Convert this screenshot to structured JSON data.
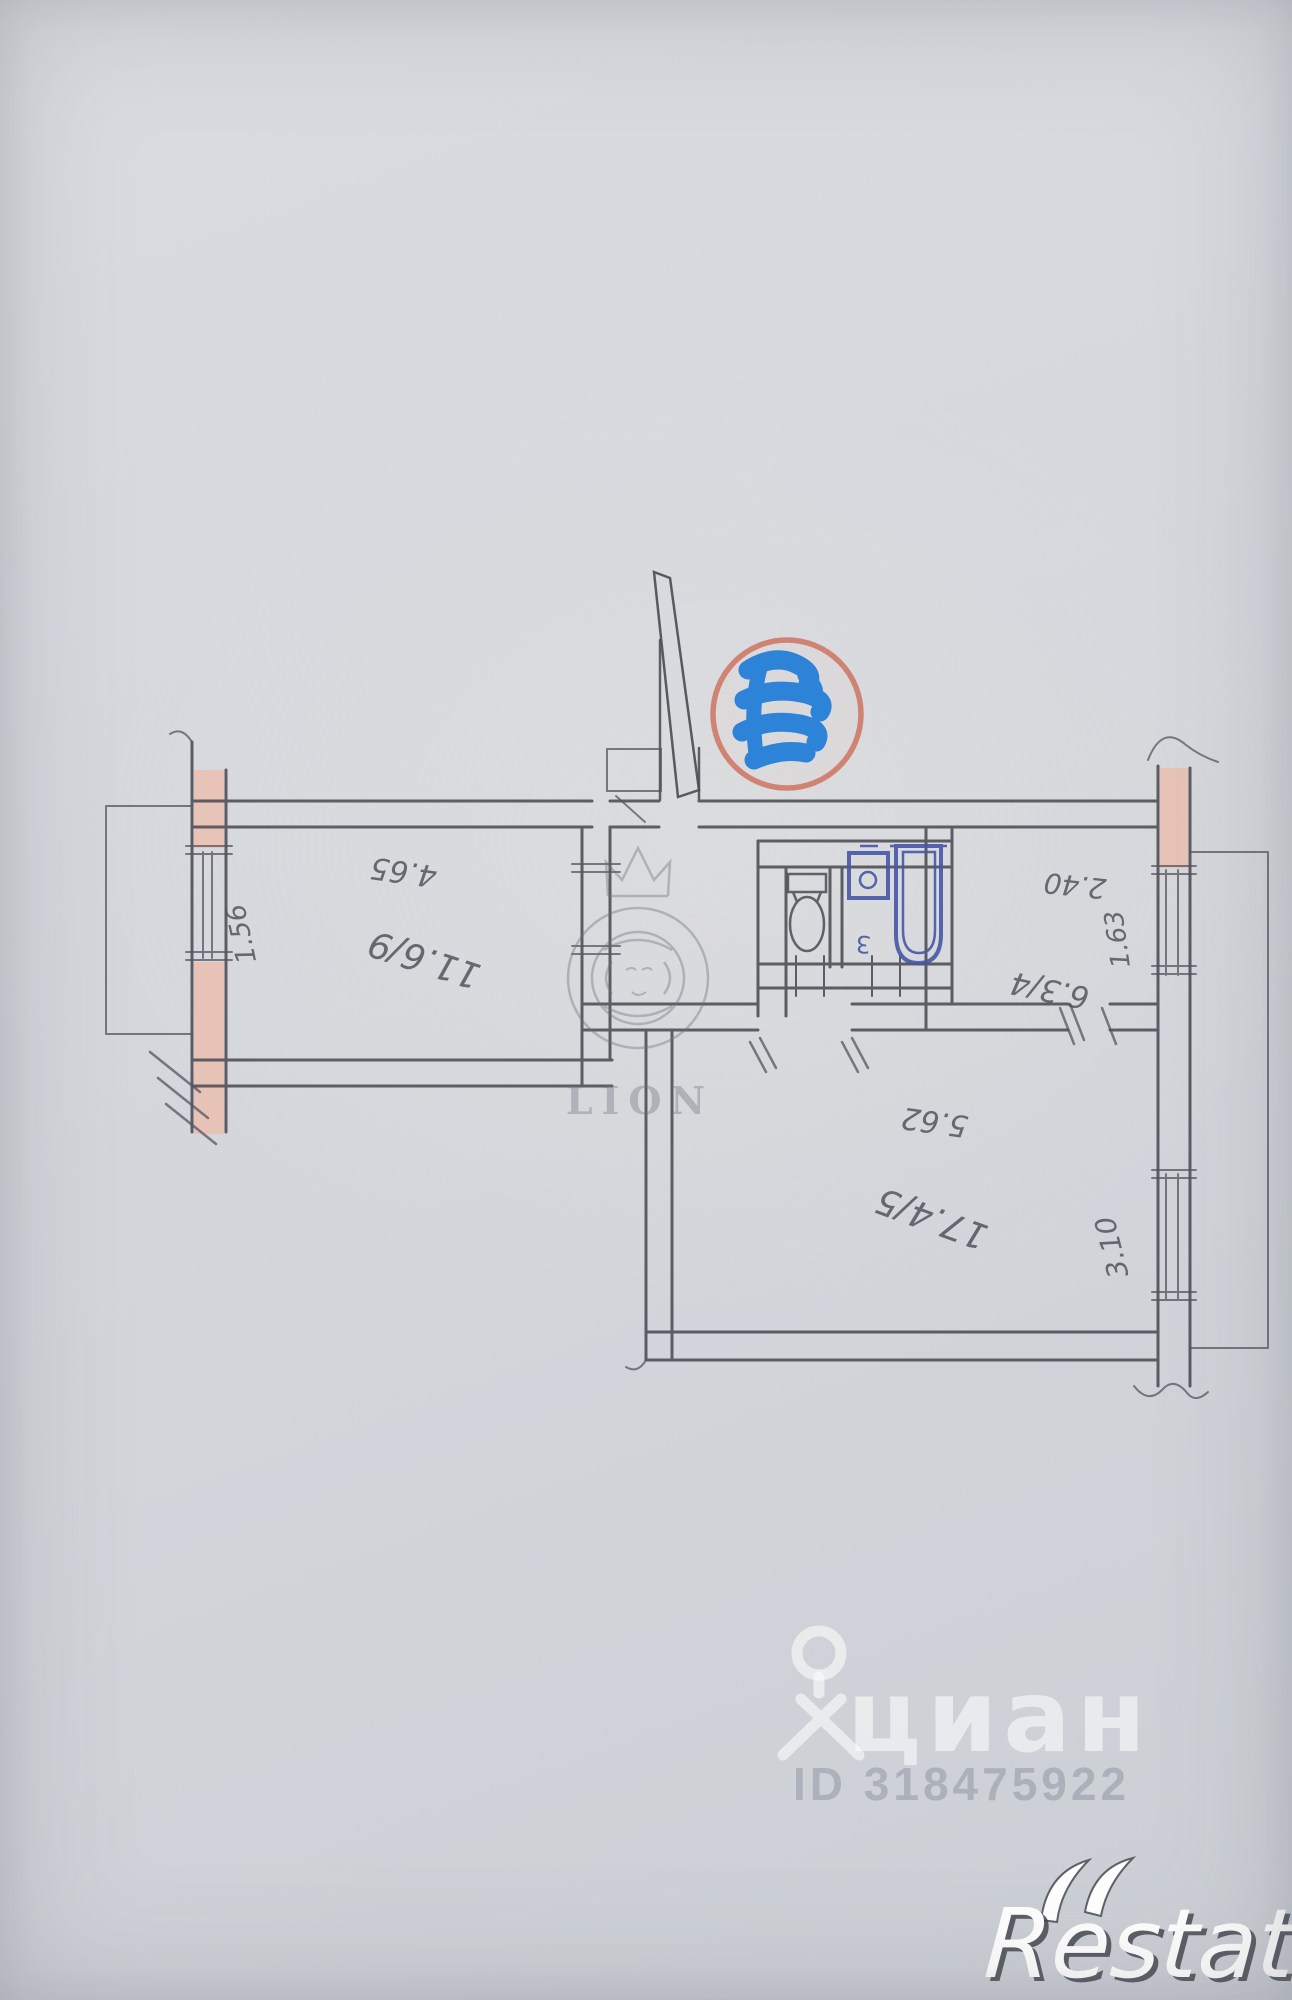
{
  "plan": {
    "rooms": [
      {
        "id": "room-9",
        "number": "9",
        "area": "11.6",
        "label": "11.6/9"
      },
      {
        "id": "room-4",
        "number": "4",
        "area": "6.3",
        "label": "6.3/4"
      },
      {
        "id": "room-5",
        "number": "5",
        "area": "17.4",
        "label": "17.4/5"
      },
      {
        "id": "wc",
        "number": "3",
        "area": "",
        "label": "3"
      }
    ],
    "dimensions": {
      "top_left": "4.65",
      "left_window": "1.56",
      "top_right": "2.40",
      "right_window_upper": "1.63",
      "center": "5.62",
      "right_window_lower": "3.10"
    }
  },
  "watermarks": {
    "lion": {
      "text": "LION"
    },
    "cian": {
      "logo_text": "циан",
      "id_text": "ID 318475922"
    },
    "restate": {
      "text": "Restate"
    }
  },
  "colors": {
    "pencil": "#4c4c54",
    "wall_fill": "#eabfb0",
    "stamp_ring": "#cf7a68",
    "scribble_blue": "#1e7cd8",
    "fixture_ink": "#4657a6",
    "paper": "#d5d8dd"
  }
}
